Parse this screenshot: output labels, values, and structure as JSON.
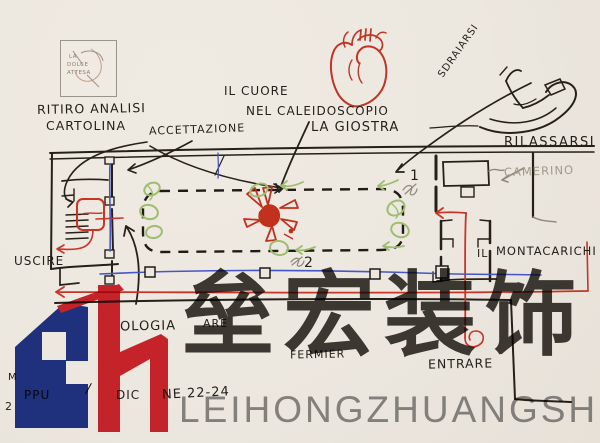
{
  "stamp": {
    "line1": "LA",
    "line2": "DOLCE",
    "line3": "ATTESA"
  },
  "labels": {
    "ritiro_line1": "RITIRO ANALISI",
    "ritiro_line2": "CARTOLINA",
    "accettazione": "ACCETTAZIONE",
    "cuore_line1": "IL CUORE",
    "cuore_line2": "NEL CALEIDOSCOPIO",
    "cuore_line3": "LA GIOSTRA",
    "sdraiarsi": "SDRAIARSI",
    "rilassarsi": "RILASSARSI",
    "camerino": "CAMERINO",
    "montacarichi_il": "IL",
    "montacarichi": "MONTACARICHI",
    "uscire": "USCIRE",
    "entrare": "ENTRARE",
    "num1": "1",
    "num2": "2",
    "frag_ologia": "OLOGIA",
    "frag_are": "ARE",
    "frag_fermier": "FERMIER",
    "frag_m": "M",
    "frag_ppu": "PPU",
    "frag_slash": "/",
    "frag_dic": "DIC",
    "frag_ne2224": "NE 22-24",
    "frag_2": "2"
  },
  "watermark": {
    "chinese_text": "垒宏装饰",
    "latin_text": "LEIHONGZHUANGSHI",
    "logo_blue": "#21368f",
    "logo_red": "#d42630"
  },
  "colors": {
    "paper": "#ece7df",
    "ink": "#262118",
    "sketch_red": "#c23424",
    "route_blue": "#4656c4",
    "plant_green": "#9dbd6f",
    "pencil_grey": "#8f897c",
    "watermark_grey": "#403d38",
    "watermark_latin_grey": "#8e8e8e"
  }
}
